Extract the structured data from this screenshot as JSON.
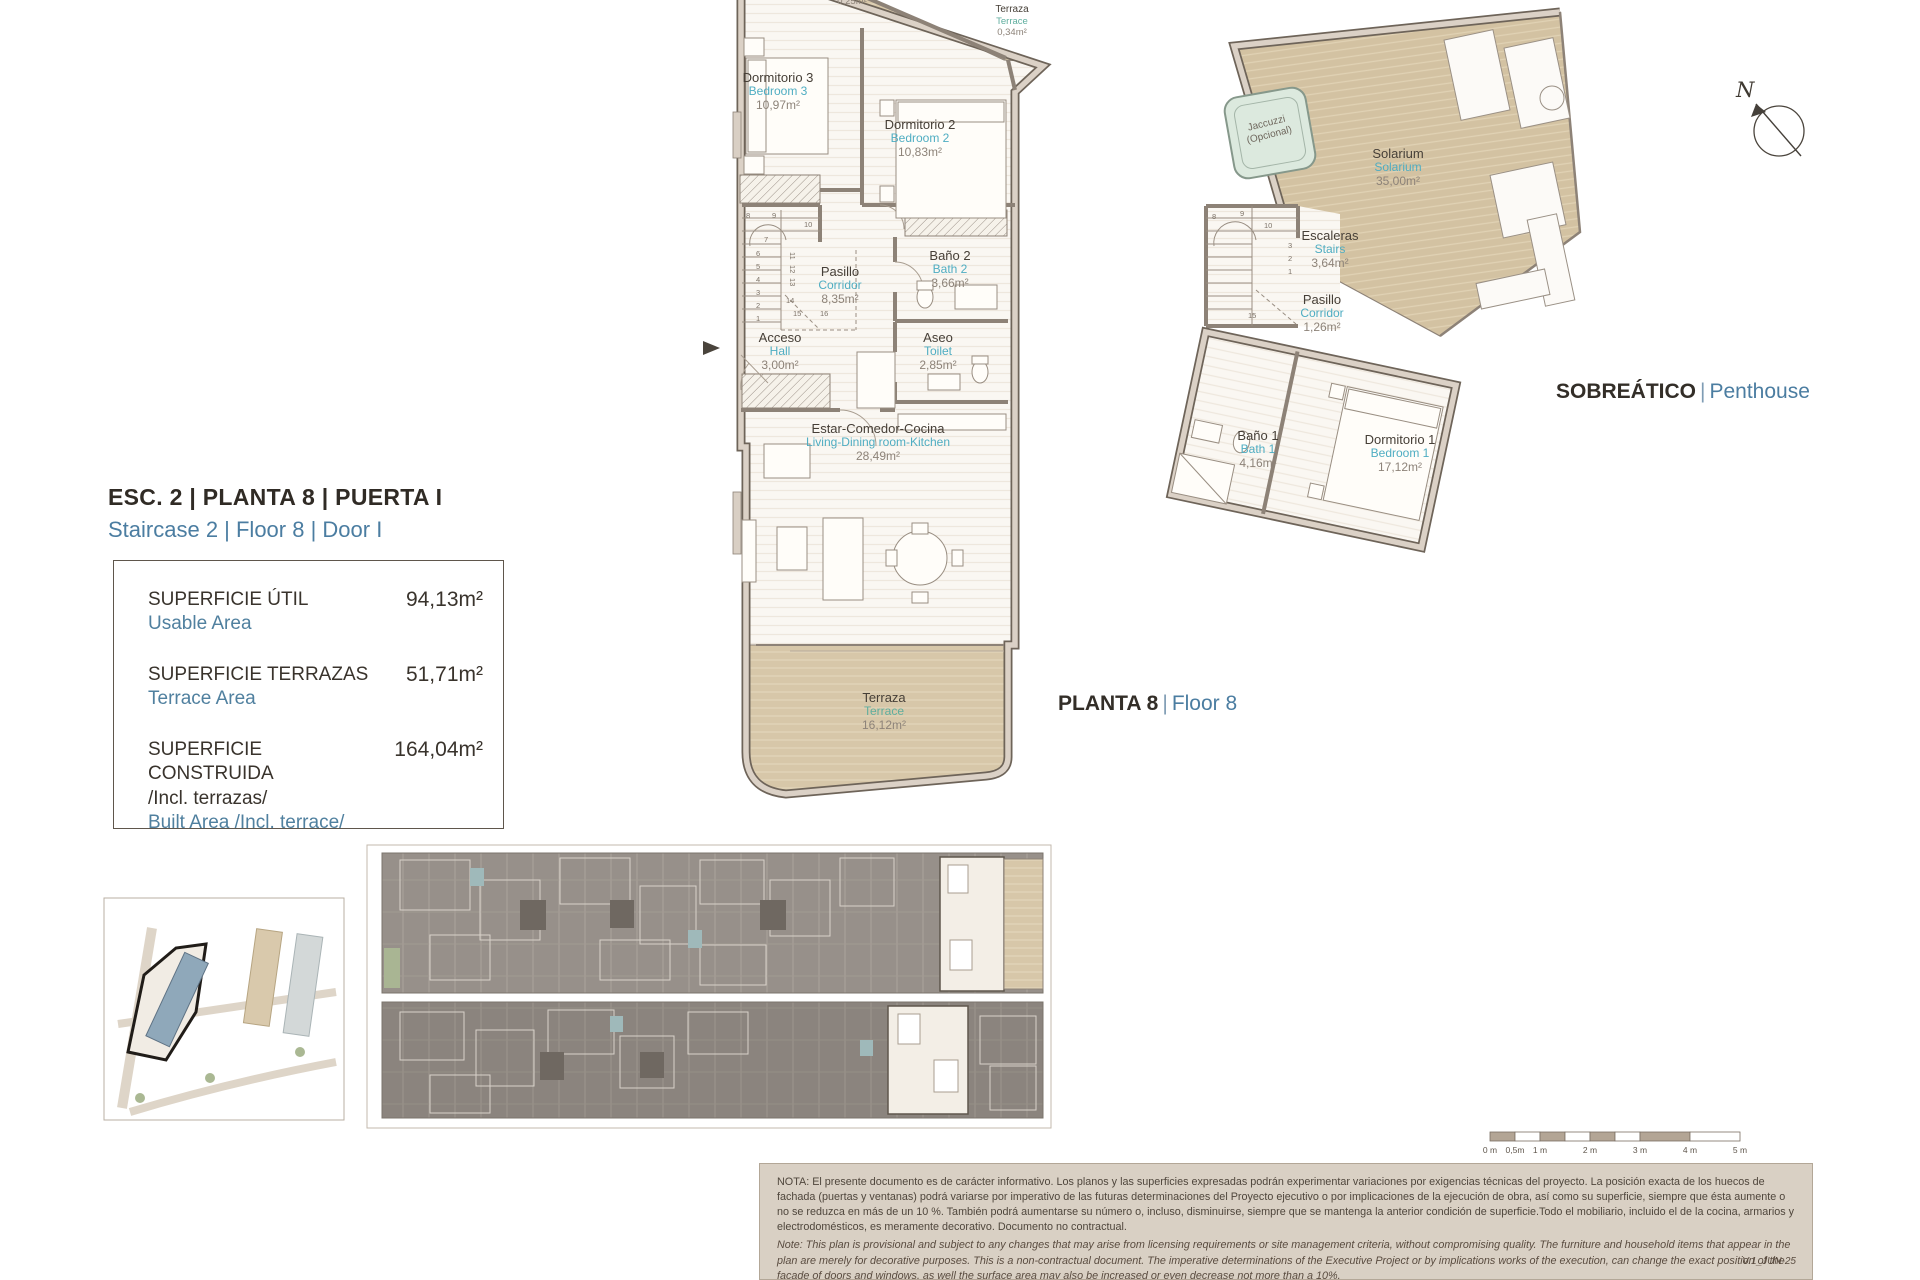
{
  "header": {
    "title_es": "ESC. 2 | PLANTA 8 | PUERTA I",
    "title_en": "Staircase 2 | Floor 8 | Door I"
  },
  "area_table": {
    "rows": [
      {
        "label_es": "SUPERFICIE ÚTIL",
        "label_es2": "",
        "label_en": "Usable Area",
        "value": "94,13m²"
      },
      {
        "label_es": "SUPERFICIE TERRAZAS",
        "label_es2": "",
        "label_en": "Terrace Area",
        "value": "51,71m²"
      },
      {
        "label_es": "SUPERFICIE CONSTRUIDA",
        "label_es2": "/Incl. terrazas/",
        "label_en": "Built Area /Incl. terrace/",
        "value": "164,04m²"
      }
    ]
  },
  "section_labels": {
    "floor8_es": "PLANTA 8",
    "floor8_en": "Floor 8",
    "penthouse_es": "SOBREÁTICO",
    "penthouse_en": "Penthouse",
    "sep": "|"
  },
  "floor8_rooms": [
    {
      "es": "",
      "en": "",
      "area": "0,25m²"
    },
    {
      "es": "Terraza",
      "en": "Terrace",
      "area": "0,34m²"
    },
    {
      "es": "Dormitorio 3",
      "en": "Bedroom 3",
      "area": "10,97m²"
    },
    {
      "es": "Dormitorio 2",
      "en": "Bedroom 2",
      "area": "10,83m²"
    },
    {
      "es": "Baño 2",
      "en": "Bath 2",
      "area": "3,66m²"
    },
    {
      "es": "Pasillo",
      "en": "Corridor",
      "area": "8,35m²"
    },
    {
      "es": "Aseo",
      "en": "Toilet",
      "area": "2,85m²"
    },
    {
      "es": "Acceso",
      "en": "Hall",
      "area": "3,00m²"
    },
    {
      "es": "Estar-Comedor-Cocina",
      "en": "Living-Dining room-Kitchen",
      "area": "28,49m²"
    },
    {
      "es": "Terraza",
      "en": "Terrace",
      "area": "16,12m²"
    }
  ],
  "penthouse_rooms": [
    {
      "es": "Jaccuzzi",
      "en": "(Opcional)",
      "area": ""
    },
    {
      "es": "Solarium",
      "en": "Solarium",
      "area": "35,00m²"
    },
    {
      "es": "Escaleras",
      "en": "Stairs",
      "area": "3,64m²"
    },
    {
      "es": "Pasillo",
      "en": "Corridor",
      "area": "1,26m²"
    },
    {
      "es": "Baño 1",
      "en": "Bath 1",
      "area": "4,16m²"
    },
    {
      "es": "Dormitorio 1",
      "en": "Bedroom 1",
      "area": "17,12m²"
    }
  ],
  "stair_numbers": [
    "1",
    "2",
    "3",
    "4",
    "5",
    "6",
    "7",
    "8",
    "9",
    "10",
    "11",
    "12",
    "13",
    "14",
    "15",
    "16"
  ],
  "compass": {
    "label": "N"
  },
  "scale_bar": {
    "labels": [
      "0 m",
      "0,5m",
      "1 m",
      "2 m",
      "3 m",
      "4 m",
      "5 m"
    ]
  },
  "notes": {
    "es": "NOTA:  El presente documento es de carácter informativo. Los planos y las superficies expresadas podrán experimentar variaciones por exigencias técnicas del proyecto. La posición exacta de los huecos de fachada (puertas y ventanas) podrá variarse por imperativo de las futuras determinaciones del Proyecto ejecutivo o por implicaciones de la ejecución de obra, así como su superficie, siempre que ésta aumente o no se reduzca en más de un 10 %. También podrá aumentarse su número o, incluso, disminuirse, siempre que se mantenga la anterior condición de superficie.Todo el mobiliario, incluido el de la cocina, armarios y electrodomésticos, es meramente decorativo. Documento no contractual.",
    "en": "Note: This plan is provisional and subject to any changes that may arise from licensing requirements or site management criteria, without compromising quality. The furniture and household items that appear in the plan are merely for decorative purposes. This is a non-contractual document. The imperative determinations of the Executive Project or by implications works of the execution, can change the exact position of the facade of doors and windows, as well the surface area may also be increased or even decrease not more than a 10%.",
    "version": "V.1_JUN-25"
  }
}
